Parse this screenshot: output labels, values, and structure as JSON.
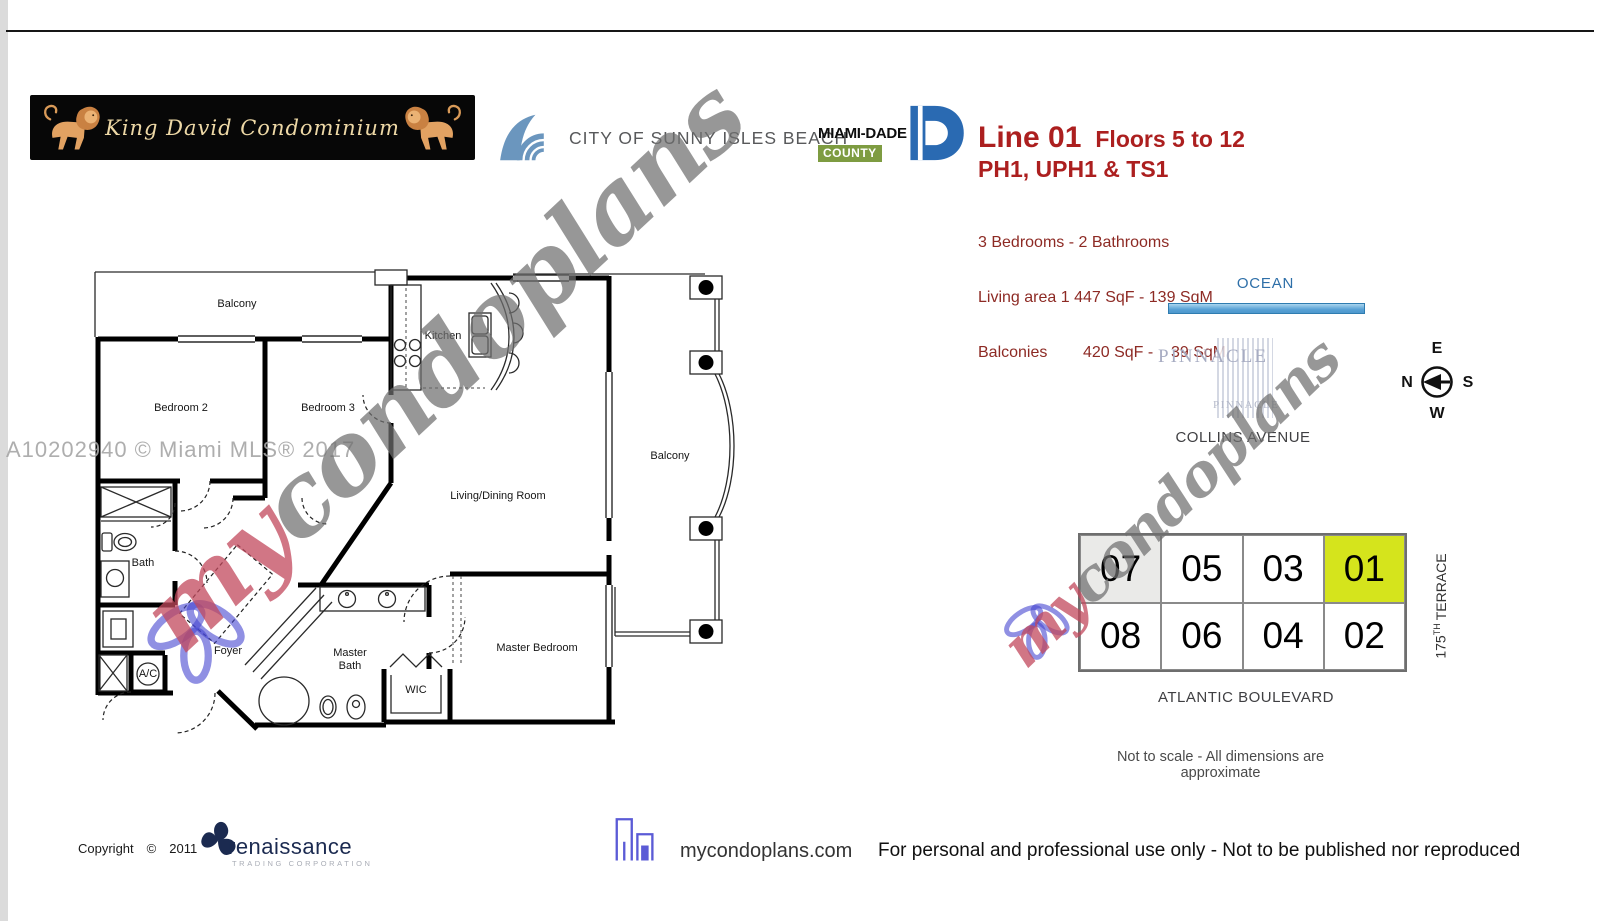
{
  "banner": {
    "title": "King David Condominium"
  },
  "city_logo": {
    "label": "CITY OF SUNNY ISLES BEACH"
  },
  "county_logo": {
    "name": "MIAMI-DADE",
    "sub": "COUNTY"
  },
  "unit_info": {
    "line": "Line 01",
    "floors": "Floors 5 to 12",
    "penthouse": "PH1, UPH1 & TS1",
    "beds": "3 Bedrooms - 2 Bathrooms",
    "living_area": "Living area 1 447 SqF - 139 SqM",
    "balconies": "Balconies        420 SqF -    39 SqM",
    "heading_color": "#AC1F1F",
    "detail_color": "#8D2A24"
  },
  "floor_plan": {
    "rooms": {
      "balcony_top": "Balcony",
      "bedroom2": "Bedroom 2",
      "bedroom3": "Bedroom 3",
      "kitchen": "Kitchen",
      "living": "Living/Dining Room",
      "balcony_right": "Balcony",
      "bath": "Bath",
      "foyer": "Foyer",
      "master_bath_line1": "Master",
      "master_bath_line2": "Bath",
      "wic": "WIC",
      "master_bedroom": "Master Bedroom",
      "ac": "A/C"
    }
  },
  "watermarks": {
    "mls": "A10202940 © Miami MLS® 2017",
    "script_my": "my",
    "script_rest": "condoplans"
  },
  "site_map": {
    "ocean": "OCEAN",
    "building": "PINNACLE",
    "building_small": "PINNACLE",
    "street_top": "COLLINS AVENUE",
    "street_bottom": "ATLANTIC BOULEVARD",
    "street_right_number": "175",
    "street_right_sup": "TH",
    "street_right_name": "TERRACE",
    "compass": {
      "top": "E",
      "left": "N",
      "right": "S",
      "bottom": "W"
    },
    "units_row1": [
      "07",
      "05",
      "03",
      "01"
    ],
    "units_row2": [
      "08",
      "06",
      "04",
      "02"
    ],
    "highlighted_unit": "01",
    "highlight_color": "#D5E41C",
    "note": "Not to scale - All dimensions are approximate"
  },
  "footer": {
    "copyright_label": "Copyright",
    "copyright_symbol": "©",
    "year": "2011",
    "brand": "renaissance",
    "brand_sub": "TRADING CORPORATION",
    "site": "mycondoplans.com",
    "disclaimer": "For personal and professional use only - Not to be published nor reproduced"
  }
}
